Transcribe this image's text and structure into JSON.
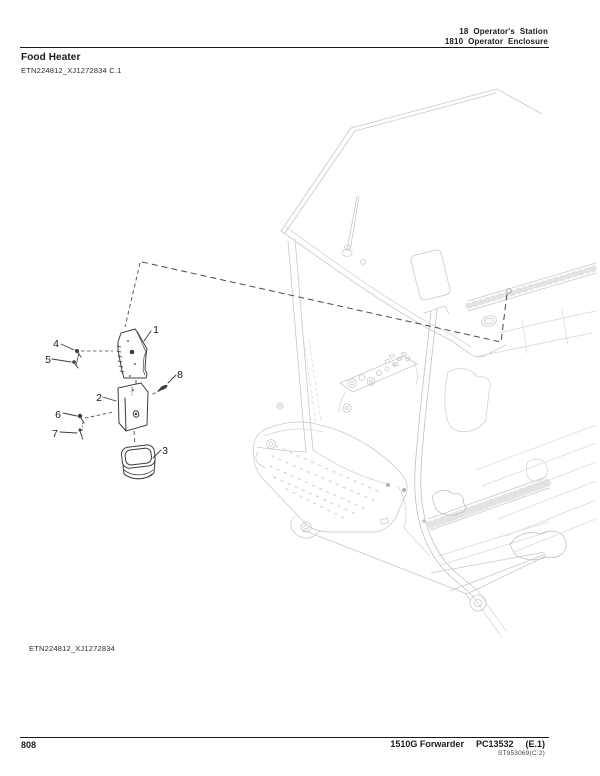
{
  "page_header": {
    "section": "18 Operator's Station",
    "subsection": "1810 Operator Enclosure"
  },
  "figure": {
    "title": "Food Heater",
    "ref_top": "ETN224812_XJ1272834 C.1",
    "ref_bottom": "ETN224812_XJ1272834"
  },
  "diagram": {
    "description": "Exploded view of food heater parts (bracket, heater body, cover, fasteners) with dashed leader to mounting location inside forwarder cab wireframe",
    "callouts": [
      {
        "label": "1"
      },
      {
        "label": "2"
      },
      {
        "label": "3"
      },
      {
        "label": "4"
      },
      {
        "label": "5"
      },
      {
        "label": "6"
      },
      {
        "label": "7"
      },
      {
        "label": "8"
      }
    ]
  },
  "page_footer": {
    "page_number": "808",
    "model": "1510G Forwarder",
    "publication": "PC13532",
    "edition": "(E.1)",
    "code": "ST953069(C.2)"
  },
  "colors": {
    "ink": "#1a1a1a",
    "machine_line": "#c7c9cb",
    "part_line": "#3d3d3d"
  }
}
